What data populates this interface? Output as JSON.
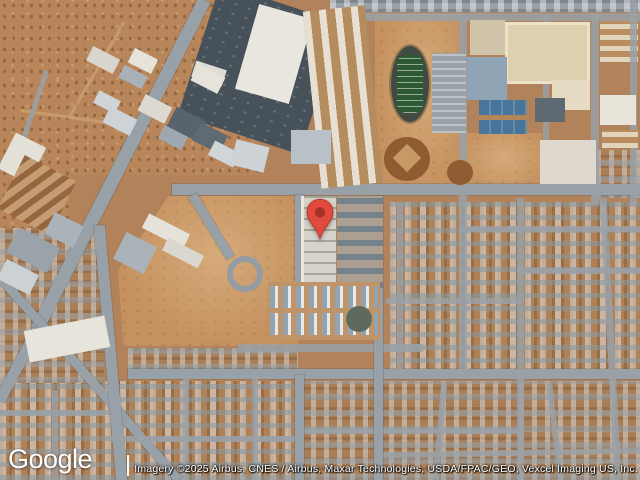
{
  "map": {
    "view_type": "satellite",
    "logo_text": "Google",
    "attribution_text": "Imagery ©2025 Airbus, CNES / Airbus, Maxar Technologies, USDA/FPAC/GEO, Vexcel Imaging US, Inc.",
    "marker": {
      "kind": "red-location-pin",
      "fill": "#E14B3E",
      "stroke": "#B93A2E",
      "dot": "#A33126"
    }
  },
  "palette": {
    "desert": "#B8865A",
    "dirt_lot": "#C4915F",
    "road_gray": "#99A1A8",
    "asphalt_parking": "#46515A",
    "warehouse_roof_white": "#E9E6DF",
    "commercial_roof_gray": "#9FA8AE",
    "gym_roof_blue_gray": "#8FA5B5",
    "school_tan": "#DECFAE",
    "football_field_green": "#2D5A33",
    "running_track": "#414B41",
    "sport_court_blue": "#47759C",
    "residential_roof_blue_gray": "#8A9BA8"
  }
}
